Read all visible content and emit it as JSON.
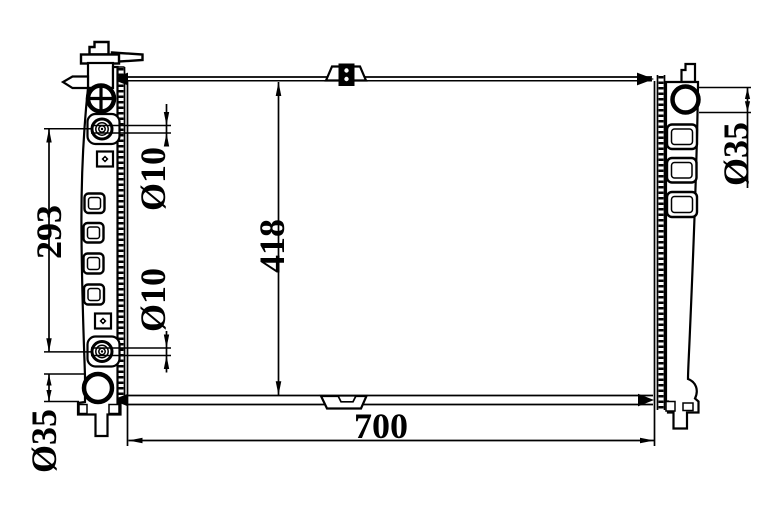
{
  "colors": {
    "line": "#000000",
    "background": "#ffffff"
  },
  "dimensions": {
    "overall_height": "418",
    "port_spacing": "293",
    "core_width": "700",
    "top_port_diameter": "Ø10",
    "bottom_port_diameter": "Ø10",
    "left_outlet_diameter": "Ø35",
    "right_outlet_diameter": "Ø35"
  }
}
